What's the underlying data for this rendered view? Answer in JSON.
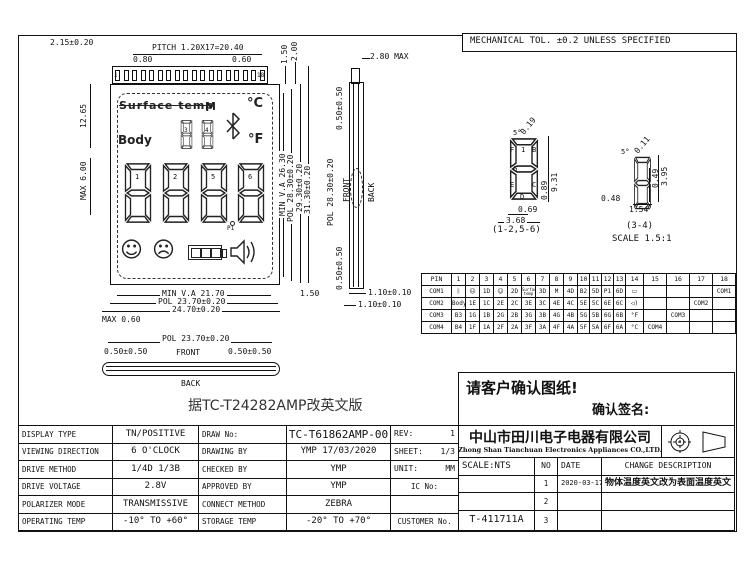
{
  "tolerance_note": "MECHANICAL TOL. ±0.2 UNLESS SPECIFIED",
  "lcd": {
    "pin_first": "1",
    "pin_last": "18",
    "surface_temp": "Surface temp",
    "m": "M",
    "body": "Body",
    "deg_c": "°C",
    "deg_f": "°F",
    "p1": "P1",
    "big_digit_ids": [
      "1",
      "2",
      "5",
      "6"
    ],
    "small_digit_ids": [
      "3",
      "4"
    ],
    "icons": {
      "bluetooth": "bluetooth-icon",
      "smiley": "smiley-icon",
      "sad_face": "sad-face-icon",
      "battery": "battery-icon",
      "speaker": "speaker-icon"
    }
  },
  "dims": {
    "top_offset": "2.15±0.20",
    "pitch": "PITCH 1.20X17=20.40",
    "p080": "0.80",
    "p060": "0.60",
    "v150_top": "1.50",
    "v200": "2.00",
    "max280": "2.80 MAX",
    "v1265": "12.65",
    "max600": "MAX 6.00",
    "max060": "MAX 0.60",
    "min_va_h": "MIN V.A 21.70",
    "pol_h": "POL 23.70±0.20",
    "total_h": "24.70±0.20",
    "r150": "1.50",
    "min_va_v": "MIN V.A 26.30",
    "pol_v": "POL 28.30±0.20",
    "glass_v": "29.30±0.20",
    "total_v": "31.30±0.20",
    "side_top_gap": "0.50±0.50",
    "side_pol": "POL 28.30±0.20",
    "side_front": "FRONT",
    "side_back": "BACK",
    "side_bot_gap": "0.50±0.50",
    "t110a": "1.10±0.10",
    "t110b": "1.10±0.10",
    "bv_pol": "POL 23.70±0.20",
    "bv_left": "0.50±0.50",
    "bv_front": "FRONT",
    "bv_right": "0.50±0.50",
    "bv_back": "BACK"
  },
  "details": {
    "big": {
      "diag": "0.19",
      "angle": "5°",
      "h1": "9.31",
      "h2": "0.89",
      "w1": "0.69",
      "w2": "3.68",
      "caption": "(1-2,5-6)",
      "letters": [
        "F",
        "1",
        "B",
        "G",
        "E",
        "C",
        "D"
      ]
    },
    "small": {
      "diag": "0.11",
      "angle": "5°",
      "h1": "0.49",
      "h2": "3.95",
      "w1": "0.48",
      "w2": "1.54",
      "caption": "(3-4)",
      "scale": "SCALE 1.5:1"
    }
  },
  "pin_table": {
    "col_header": "PIN",
    "pins": [
      "1",
      "2",
      "3",
      "4",
      "5",
      "6",
      "7",
      "8",
      "9",
      "10",
      "11",
      "12",
      "13",
      "14",
      "15",
      "16",
      "17",
      "18"
    ],
    "rows": [
      {
        "label": "COM1",
        "cells": [
          "ᛒ",
          "☹",
          "1D",
          "☺",
          "2D",
          "Surface temp",
          "3D",
          "M",
          "4D",
          "B2",
          "5D",
          "P1",
          "6D",
          "▭",
          "",
          "",
          "",
          "COM1"
        ]
      },
      {
        "label": "COM2",
        "cells": [
          "Body",
          "1E",
          "1C",
          "2E",
          "2C",
          "3E",
          "3C",
          "4E",
          "4C",
          "5E",
          "5C",
          "6E",
          "6C",
          "◁)",
          "",
          "",
          "COM2",
          ""
        ]
      },
      {
        "label": "COM3",
        "cells": [
          "B3",
          "1G",
          "1B",
          "2G",
          "2B",
          "3G",
          "3B",
          "4G",
          "4B",
          "5G",
          "5B",
          "6G",
          "6B",
          "°F",
          "",
          "COM3",
          "",
          ""
        ]
      },
      {
        "label": "COM4",
        "cells": [
          "B4",
          "1F",
          "1A",
          "2F",
          "2A",
          "3F",
          "3A",
          "4F",
          "4A",
          "5F",
          "5A",
          "6F",
          "6A",
          "°C",
          "COM4",
          "",
          "",
          ""
        ]
      }
    ]
  },
  "confirm_box": {
    "line1": "请客户确认图纸!",
    "line2": "确认签名:"
  },
  "center_note": "据TC-T24282AMP改英文版",
  "title_block": {
    "left_rows": [
      {
        "label": "DISPLAY TYPE",
        "value": "TN/POSITIVE"
      },
      {
        "label": "VIEWING DIRECTION",
        "value": "6 O'CLOCK"
      },
      {
        "label": "DRIVE METHOD",
        "value": "1/4D  1/3B"
      },
      {
        "label": "DRIVE VOLTAGE",
        "value": "2.8V"
      },
      {
        "label": "POLARIZER MODE",
        "value": "TRANSMISSIVE"
      },
      {
        "label": "OPERATING TEMP",
        "value": "-10° TO +60°"
      }
    ],
    "mid_rows": [
      {
        "label": "DRAW No:",
        "value": "TC-T61862AMP-00",
        "extra": "REV:",
        "extra_value": "1"
      },
      {
        "label": "DRAWING BY",
        "value": "YMP  17/03/2020",
        "extra": "SHEET:",
        "extra_value": "1/3"
      },
      {
        "label": "CHECKED BY",
        "value": "YMP",
        "extra": "UNIT:",
        "extra_value": "MM"
      },
      {
        "label": "APPROVED BY",
        "value": "YMP",
        "extra": "IC No:",
        "extra_value": ""
      },
      {
        "label": "CONNECT METHOD",
        "value": "ZEBRA",
        "extra": "",
        "extra_value": ""
      },
      {
        "label": "STORAGE TEMP",
        "value": "-20° TO +70°",
        "extra": "CUSTOMER No.",
        "extra_value": ""
      }
    ],
    "company": {
      "name_cn": "中山市田川电子电器有限公司",
      "name_en": "Zhong Shan Tianchuan Electronics Appliances CO.,LTD."
    },
    "revision": {
      "scale": "SCALE:NTS",
      "no_header": "NO",
      "date_header": "DATE",
      "desc_header": "CHANGE DESCRIPTION",
      "rows": [
        {
          "no": "1",
          "date": "2020-03-17",
          "desc": "物体温度英文改为表面温度英文"
        },
        {
          "no": "2",
          "date": "",
          "desc": ""
        },
        {
          "no": "3",
          "date": "",
          "desc": ""
        }
      ],
      "customer_no": "T-411711A"
    }
  }
}
